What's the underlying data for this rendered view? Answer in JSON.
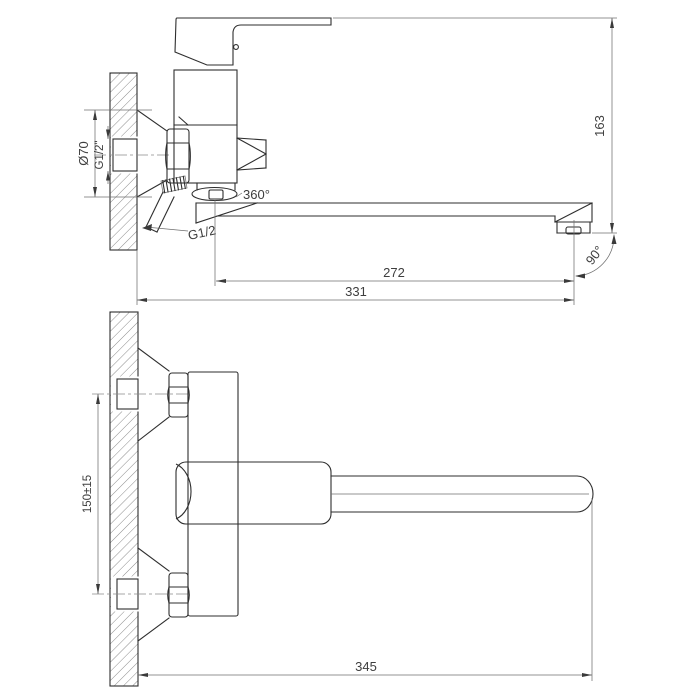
{
  "page": {
    "background": "#ffffff"
  },
  "drawing": {
    "stroke_color": "#2e2e2e",
    "thin_color": "#6f6f6f",
    "text_color": "#3e3e3e"
  },
  "labels": {
    "side_view": {
      "escutcheon_diameter": "Ø70",
      "inlet_thread": "G1/2\"",
      "swivel_rotation": "360°",
      "shower_thread": "G1/2",
      "spout_reach": "272",
      "overall_reach": "331",
      "overall_height": "163",
      "spout_swing": "90°"
    },
    "front_view": {
      "inlet_centers": "150±15",
      "overall_length": "345"
    }
  }
}
